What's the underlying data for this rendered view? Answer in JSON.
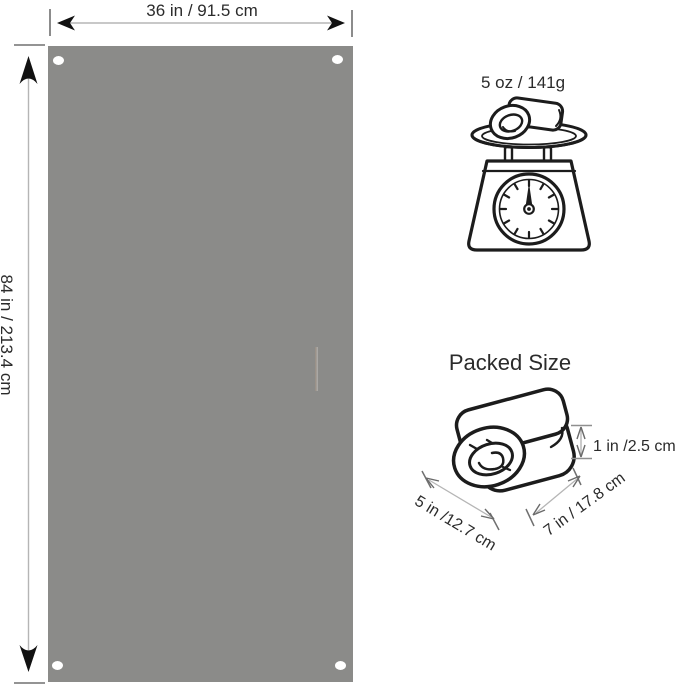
{
  "tarp": {
    "width_label": "36 in / 91.5 cm",
    "height_label": "84 in / 213.4 cm",
    "fill_color": "#8b8b89",
    "grommet_color": "#ffffff",
    "grommet_count": 4
  },
  "weight": {
    "label": "5 oz / 141g",
    "icon": "kitchen-scale-icon"
  },
  "packed_size": {
    "title": "Packed Size",
    "icon": "rolled-blanket-icon",
    "thickness_label": "1 in /2.5 cm",
    "width_label": "5 in /12.7 cm",
    "length_label": "7 in / 17.8 cm"
  },
  "colors": {
    "background": "#ffffff",
    "line_art": "#1c1c1c",
    "dimension_line": "#b5b5b5",
    "dimension_tick": "#707070",
    "arrowhead": "#111111",
    "text": "#2b2b2b"
  }
}
